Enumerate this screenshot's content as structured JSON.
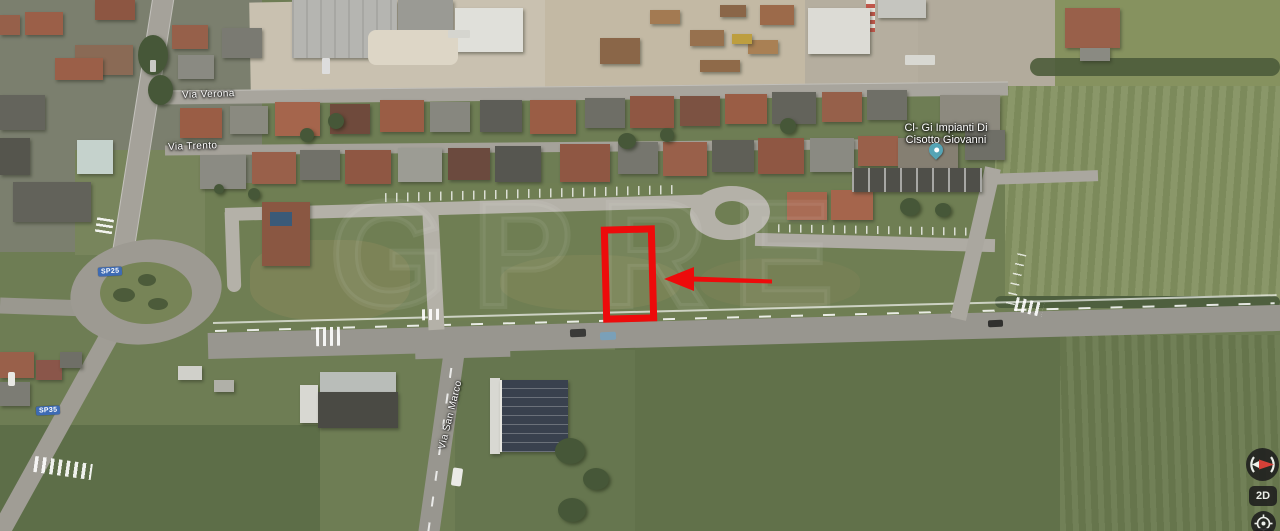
{
  "map": {
    "view_type": "satellite",
    "street_labels": [
      {
        "name": "Via Verona"
      },
      {
        "name": "Via Trento"
      },
      {
        "name": "Via San Marco"
      }
    ],
    "road_shields": [
      {
        "code": "SP25"
      },
      {
        "code": "SP35"
      }
    ],
    "poi_label": {
      "line1": "Cl- Gi Impianti Di",
      "line2": "Cisotto Giovanni"
    },
    "watermark_text": "GPRE"
  },
  "annotation": {
    "shape": "rectangle-outline",
    "arrow_direction": "left"
  },
  "controls": {
    "view_toggle": "2D"
  },
  "colors": {
    "annotation_red": "#ed0b0b",
    "shield_blue": "#3e6bb4",
    "poi_pin_teal": "#55a4b5",
    "control_bg": "#1e1e1e",
    "label_text": "#ffffff"
  }
}
